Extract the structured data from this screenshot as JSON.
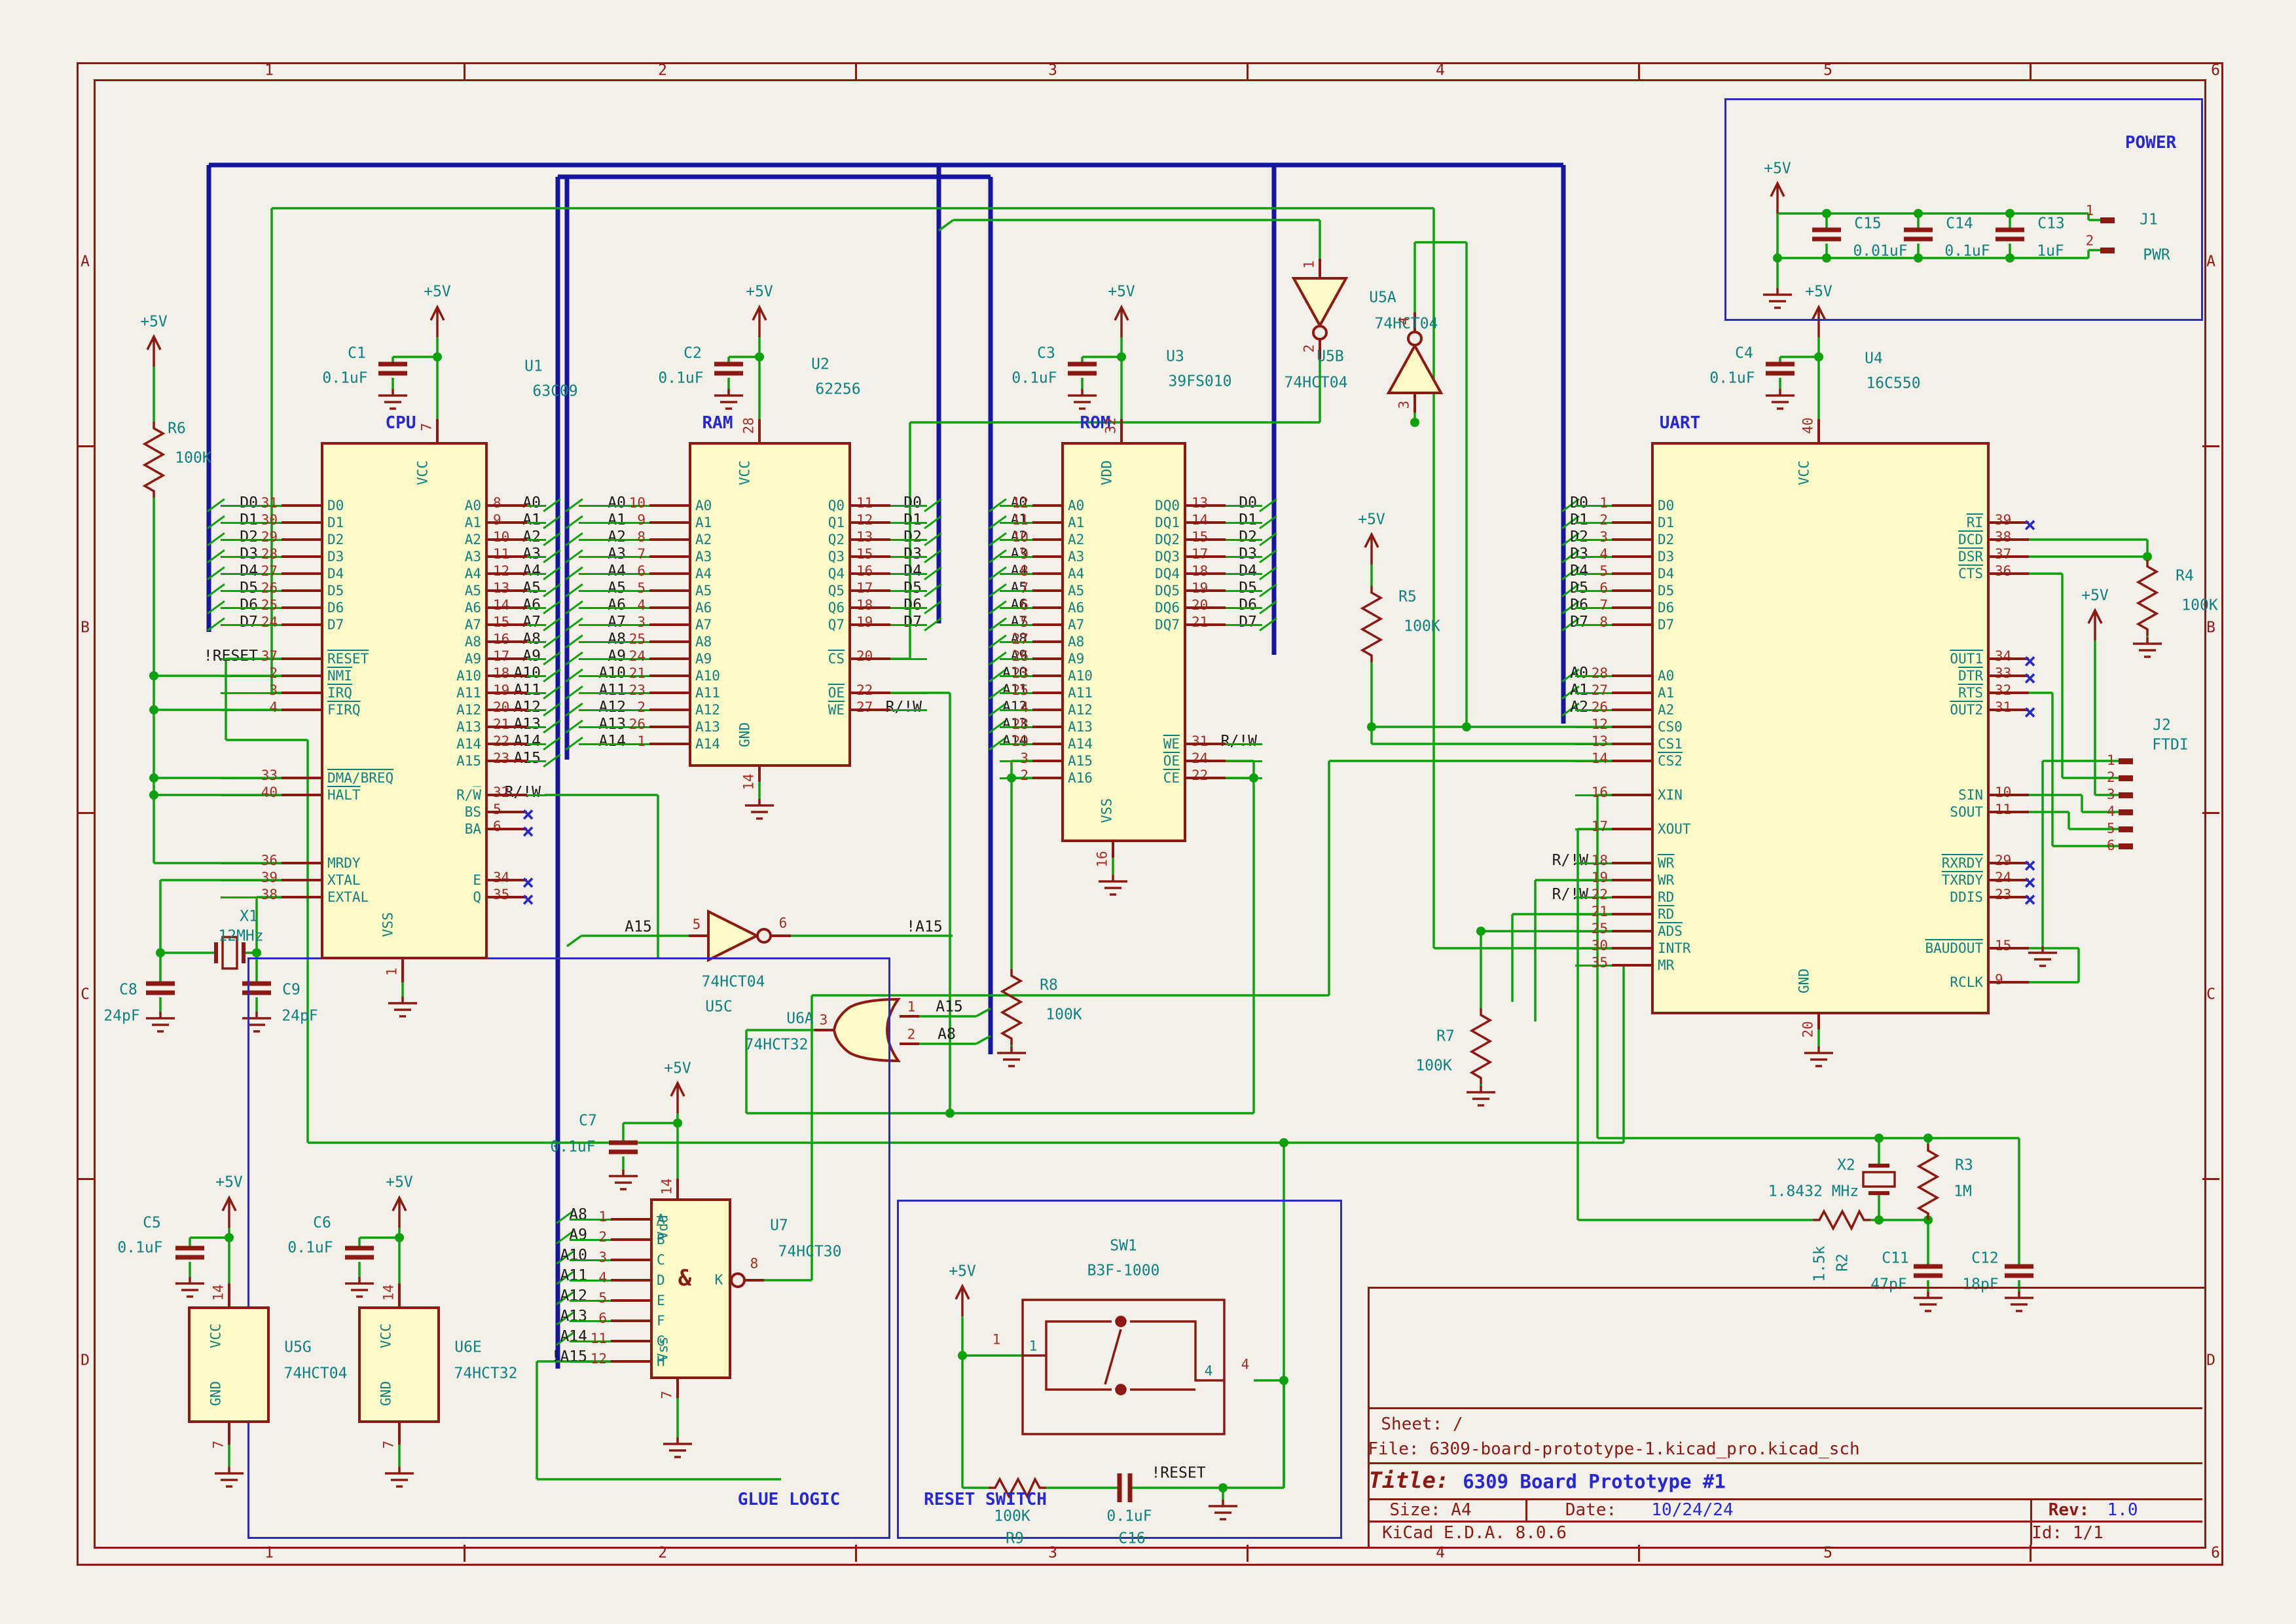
{
  "sheet": {
    "columns": [
      "1",
      "2",
      "3",
      "4",
      "5",
      "6"
    ],
    "rows": [
      "A",
      "B",
      "C",
      "D"
    ]
  },
  "title_block": {
    "sheet": "Sheet: /",
    "file": "File: 6309-board-prototype-1.kicad_pro.kicad_sch",
    "title_label": "Title:",
    "title": "6309 Board Prototype #1",
    "size": "Size: A4",
    "date_label": "Date:",
    "date": "10/24/24",
    "rev_label": "Rev:",
    "rev": "1.0",
    "tool": "KiCad E.D.A. 8.0.6",
    "id": "Id: 1/1"
  },
  "section_labels": {
    "power": "POWER",
    "glue": "GLUE LOGIC",
    "reset": "RESET SWITCH"
  },
  "power_net": "+5V",
  "net_labels": {
    "reset": "!RESET",
    "rw": "R/!W",
    "a15": "A15",
    "na15": "!A15",
    "a8": "A8"
  },
  "components": {
    "cpu": {
      "section": "CPU",
      "ref": "U1",
      "value": "63C09",
      "top": {
        "n": "7",
        "t": "VCC"
      },
      "bottom": {
        "n": "1",
        "t": "VSS"
      },
      "left": [
        {
          "n": "31",
          "t": "D0",
          "l": "D0",
          "s": 1
        },
        {
          "n": "30",
          "t": "D1",
          "l": "D1",
          "s": 1
        },
        {
          "n": "29",
          "t": "D2",
          "l": "D2",
          "s": 1
        },
        {
          "n": "28",
          "t": "D3",
          "l": "D3",
          "s": 1
        },
        {
          "n": "27",
          "t": "D4",
          "l": "D4",
          "s": 1
        },
        {
          "n": "26",
          "t": "D5",
          "l": "D5",
          "s": 1
        },
        {
          "n": "25",
          "t": "D6",
          "l": "D6",
          "s": 1
        },
        {
          "n": "24",
          "t": "D7",
          "l": "D7",
          "s": 1
        },
        {
          "sp": 1
        },
        {
          "n": "37",
          "t": "RESET",
          "b": 1,
          "l": "!RESET"
        },
        {
          "n": "2",
          "t": "NMI",
          "b": 1
        },
        {
          "n": "3",
          "t": "IRQ",
          "b": 1
        },
        {
          "n": "4",
          "t": "FIRQ",
          "b": 1
        },
        {
          "sp": 3
        },
        {
          "n": "33",
          "t": "DMA/BREQ",
          "b": 1
        },
        {
          "n": "40",
          "t": "HALT",
          "b": 1
        },
        {
          "sp": 3
        },
        {
          "n": "36",
          "t": "MRDY"
        },
        {
          "n": "39",
          "t": "XTAL"
        },
        {
          "n": "38",
          "t": "EXTAL"
        }
      ],
      "right": [
        {
          "n": "8",
          "t": "A0",
          "l": "A0",
          "s": 1
        },
        {
          "n": "9",
          "t": "A1",
          "l": "A1",
          "s": 1
        },
        {
          "n": "10",
          "t": "A2",
          "l": "A2",
          "s": 1
        },
        {
          "n": "11",
          "t": "A3",
          "l": "A3",
          "s": 1
        },
        {
          "n": "12",
          "t": "A4",
          "l": "A4",
          "s": 1
        },
        {
          "n": "13",
          "t": "A5",
          "l": "A5",
          "s": 1
        },
        {
          "n": "14",
          "t": "A6",
          "l": "A6",
          "s": 1
        },
        {
          "n": "15",
          "t": "A7",
          "l": "A7",
          "s": 1
        },
        {
          "n": "16",
          "t": "A8",
          "l": "A8",
          "s": 1
        },
        {
          "n": "17",
          "t": "A9",
          "l": "A9",
          "s": 1
        },
        {
          "n": "18",
          "t": "A10",
          "l": "A10",
          "s": 1
        },
        {
          "n": "19",
          "t": "A11",
          "l": "A11",
          "s": 1
        },
        {
          "n": "20",
          "t": "A12",
          "l": "A12",
          "s": 1
        },
        {
          "n": "21",
          "t": "A13",
          "l": "A13",
          "s": 1
        },
        {
          "n": "22",
          "t": "A14",
          "l": "A14",
          "s": 1
        },
        {
          "n": "23",
          "t": "A15",
          "l": "A15",
          "s": 1
        },
        {
          "sp": 1
        },
        {
          "n": "32",
          "t": "R/W̅",
          "l": "R/!W"
        },
        {
          "n": "5",
          "t": "BS",
          "x": 1
        },
        {
          "n": "6",
          "t": "BA",
          "x": 1
        },
        {
          "sp": 2
        },
        {
          "n": "34",
          "t": "E",
          "x": 1
        },
        {
          "n": "35",
          "t": "Q",
          "x": 1
        }
      ]
    },
    "ram": {
      "section": "RAM",
      "ref": "U2",
      "value": "62256",
      "top": {
        "n": "28",
        "t": "VCC"
      },
      "bottom": {
        "n": "14",
        "t": "GND"
      },
      "left": [
        {
          "n": "10",
          "t": "A0",
          "l": "A0",
          "s": 1
        },
        {
          "n": "9",
          "t": "A1",
          "l": "A1",
          "s": 1
        },
        {
          "n": "8",
          "t": "A2",
          "l": "A2",
          "s": 1
        },
        {
          "n": "7",
          "t": "A3",
          "l": "A3",
          "s": 1
        },
        {
          "n": "6",
          "t": "A4",
          "l": "A4",
          "s": 1
        },
        {
          "n": "5",
          "t": "A5",
          "l": "A5",
          "s": 1
        },
        {
          "n": "4",
          "t": "A6",
          "l": "A6",
          "s": 1
        },
        {
          "n": "3",
          "t": "A7",
          "l": "A7",
          "s": 1
        },
        {
          "n": "25",
          "t": "A8",
          "l": "A8",
          "s": 1
        },
        {
          "n": "24",
          "t": "A9",
          "l": "A9",
          "s": 1
        },
        {
          "n": "21",
          "t": "A10",
          "l": "A10",
          "s": 1
        },
        {
          "n": "23",
          "t": "A11",
          "l": "A11",
          "s": 1
        },
        {
          "n": "2",
          "t": "A12",
          "l": "A12",
          "s": 1
        },
        {
          "n": "26",
          "t": "A13",
          "l": "A13",
          "s": 1
        },
        {
          "n": "1",
          "t": "A14",
          "l": "A14",
          "s": 1
        }
      ],
      "right": [
        {
          "n": "11",
          "t": "Q0",
          "l": "D0",
          "s": 1
        },
        {
          "n": "12",
          "t": "Q1",
          "l": "D1",
          "s": 1
        },
        {
          "n": "13",
          "t": "Q2",
          "l": "D2",
          "s": 1
        },
        {
          "n": "15",
          "t": "Q3",
          "l": "D3",
          "s": 1
        },
        {
          "n": "16",
          "t": "Q4",
          "l": "D4",
          "s": 1
        },
        {
          "n": "17",
          "t": "Q5",
          "l": "D5",
          "s": 1
        },
        {
          "n": "18",
          "t": "Q6",
          "l": "D6",
          "s": 1
        },
        {
          "n": "19",
          "t": "Q7",
          "l": "D7",
          "s": 1
        },
        {
          "sp": 1
        },
        {
          "n": "20",
          "t": "CS",
          "b": 1
        },
        {
          "sp": 1
        },
        {
          "n": "22",
          "t": "OE",
          "b": 1
        },
        {
          "n": "27",
          "t": "WE",
          "b": 1,
          "l": "R/!W"
        }
      ]
    },
    "rom": {
      "section": "ROM",
      "ref": "U3",
      "value": "39FS010",
      "top": {
        "n": "32",
        "t": "VDD"
      },
      "bottom": {
        "n": "16",
        "t": "VSS"
      },
      "left": [
        {
          "n": "12",
          "t": "A0",
          "l": "A0",
          "s": 1
        },
        {
          "n": "11",
          "t": "A1",
          "l": "A1",
          "s": 1
        },
        {
          "n": "10",
          "t": "A2",
          "l": "A2",
          "s": 1
        },
        {
          "n": "9",
          "t": "A3",
          "l": "A3",
          "s": 1
        },
        {
          "n": "8",
          "t": "A4",
          "l": "A4",
          "s": 1
        },
        {
          "n": "7",
          "t": "A5",
          "l": "A5",
          "s": 1
        },
        {
          "n": "6",
          "t": "A6",
          "l": "A6",
          "s": 1
        },
        {
          "n": "5",
          "t": "A7",
          "l": "A7",
          "s": 1
        },
        {
          "n": "27",
          "t": "A8",
          "l": "A8",
          "s": 1
        },
        {
          "n": "26",
          "t": "A9",
          "l": "A9",
          "s": 1
        },
        {
          "n": "23",
          "t": "A10",
          "l": "A10",
          "s": 1
        },
        {
          "n": "25",
          "t": "A11",
          "l": "A11",
          "s": 1
        },
        {
          "n": "4",
          "t": "A12",
          "l": "A12",
          "s": 1
        },
        {
          "n": "28",
          "t": "A13",
          "l": "A13",
          "s": 1
        },
        {
          "n": "29",
          "t": "A14",
          "l": "A14",
          "s": 1
        },
        {
          "n": "3",
          "t": "A15"
        },
        {
          "n": "2",
          "t": "A16"
        }
      ],
      "right": [
        {
          "n": "13",
          "t": "DQ0",
          "l": "D0",
          "s": 1
        },
        {
          "n": "14",
          "t": "DQ1",
          "l": "D1",
          "s": 1
        },
        {
          "n": "15",
          "t": "DQ2",
          "l": "D2",
          "s": 1
        },
        {
          "n": "17",
          "t": "DQ3",
          "l": "D3",
          "s": 1
        },
        {
          "n": "18",
          "t": "DQ4",
          "l": "D4",
          "s": 1
        },
        {
          "n": "19",
          "t": "DQ5",
          "l": "D5",
          "s": 1
        },
        {
          "n": "20",
          "t": "DQ6",
          "l": "D6",
          "s": 1
        },
        {
          "n": "21",
          "t": "DQ7",
          "l": "D7",
          "s": 1
        },
        {
          "sp": 6
        },
        {
          "n": "31",
          "t": "WE",
          "b": 1,
          "l": "R/!W"
        },
        {
          "n": "24",
          "t": "OE",
          "b": 1
        },
        {
          "n": "22",
          "t": "CE",
          "b": 1
        }
      ]
    },
    "uart": {
      "section": "UART",
      "ref": "U4",
      "value": "16C550",
      "top": {
        "n": "40",
        "t": "VCC"
      },
      "bottom": {
        "n": "20",
        "t": "GND"
      },
      "left": [
        {
          "n": "1",
          "t": "D0",
          "l": "D0",
          "s": 1
        },
        {
          "n": "2",
          "t": "D1",
          "l": "D1",
          "s": 1
        },
        {
          "n": "3",
          "t": "D2",
          "l": "D2",
          "s": 1
        },
        {
          "n": "4",
          "t": "D3",
          "l": "D3",
          "s": 1
        },
        {
          "n": "5",
          "t": "D4",
          "l": "D4",
          "s": 1
        },
        {
          "n": "6",
          "t": "D5",
          "l": "D5",
          "s": 1
        },
        {
          "n": "7",
          "t": "D6",
          "l": "D6",
          "s": 1
        },
        {
          "n": "8",
          "t": "D7",
          "l": "D7",
          "s": 1
        },
        {
          "sp": 2
        },
        {
          "n": "28",
          "t": "A0",
          "l": "A0",
          "s": 1
        },
        {
          "n": "27",
          "t": "A1",
          "l": "A1",
          "s": 1
        },
        {
          "n": "26",
          "t": "A2",
          "l": "A2",
          "s": 1
        },
        {
          "n": "12",
          "t": "CS0"
        },
        {
          "n": "13",
          "t": "CS1"
        },
        {
          "n": "14",
          "t": "CS2",
          "b": 1
        },
        {
          "sp": 1
        },
        {
          "n": "16",
          "t": "XIN"
        },
        {
          "sp": 1
        },
        {
          "n": "17",
          "t": "XOUT"
        },
        {
          "sp": 1
        },
        {
          "n": "18",
          "t": "WR",
          "b": 1,
          "l": "R/!W"
        },
        {
          "n": "19",
          "t": "WR"
        },
        {
          "n": "22",
          "t": "RD",
          "l": "R/!W"
        },
        {
          "n": "21",
          "t": "RD",
          "b": 1
        },
        {
          "n": "25",
          "t": "ADS",
          "b": 1
        },
        {
          "n": "30",
          "t": "INTR"
        },
        {
          "n": "35",
          "t": "MR"
        }
      ],
      "right": [
        {
          "sp": 1
        },
        {
          "n": "39",
          "t": "RI",
          "b": 1,
          "x": 1
        },
        {
          "n": "38",
          "t": "DCD",
          "b": 1
        },
        {
          "n": "37",
          "t": "DSR",
          "b": 1
        },
        {
          "n": "36",
          "t": "CTS",
          "b": 1
        },
        {
          "sp": 4
        },
        {
          "n": "34",
          "t": "OUT1",
          "b": 1,
          "x": 1
        },
        {
          "n": "33",
          "t": "DTR",
          "b": 1,
          "x": 1
        },
        {
          "n": "32",
          "t": "RTS",
          "b": 1
        },
        {
          "n": "31",
          "t": "OUT2",
          "b": 1,
          "x": 1
        },
        {
          "sp": 4
        },
        {
          "n": "10",
          "t": "SIN"
        },
        {
          "n": "11",
          "t": "SOUT"
        },
        {
          "sp": 2
        },
        {
          "n": "29",
          "t": "RXRDY",
          "b": 1,
          "x": 1
        },
        {
          "n": "24",
          "t": "TXRDY",
          "b": 1,
          "x": 1
        },
        {
          "n": "23",
          "t": "DDIS",
          "x": 1
        },
        {
          "sp": 2
        },
        {
          "n": "15",
          "t": "BAUDOUT",
          "b": 1
        },
        {
          "sp": 1
        },
        {
          "n": "9",
          "t": "RCLK"
        }
      ]
    },
    "u5a": {
      "ref": "U5A",
      "value": "74HCT04",
      "pin_in": "1",
      "pin_out": "2"
    },
    "u5b": {
      "ref": "U5B",
      "value": "74HCT04",
      "pin_in": "3",
      "pin_out": "4"
    },
    "u5c": {
      "ref": "U5C",
      "value": "74HCT04",
      "pin_in": "5",
      "pin_out": "6"
    },
    "u6a": {
      "ref": "U6A",
      "value": "74HCT32",
      "pin_out": "3",
      "pin_in1": "1",
      "pin_in2": "2"
    },
    "u7": {
      "ref": "U7",
      "value": "74HCT30",
      "gate": "&",
      "out_n": "8",
      "out_t": "K",
      "top": {
        "n": "14",
        "t": "Vdd"
      },
      "bottom": {
        "n": "7",
        "t": "Vss"
      },
      "left": [
        {
          "n": "1",
          "t": "A",
          "l": "A8",
          "s": 1
        },
        {
          "n": "2",
          "t": "B",
          "l": "A9",
          "s": 1
        },
        {
          "n": "3",
          "t": "C",
          "l": "A10",
          "s": 1
        },
        {
          "n": "4",
          "t": "D",
          "l": "A11",
          "s": 1
        },
        {
          "n": "5",
          "t": "E",
          "l": "A12",
          "s": 1
        },
        {
          "n": "6",
          "t": "F",
          "l": "A13",
          "s": 1
        },
        {
          "n": "11",
          "t": "G",
          "l": "A14",
          "s": 1
        },
        {
          "n": "12",
          "t": "H",
          "l": "!A15"
        }
      ]
    },
    "u5g": {
      "ref": "U5G",
      "value": "74HCT04",
      "top": {
        "n": "14",
        "t": "VCC"
      },
      "bottom": {
        "n": "7",
        "t": "GND"
      }
    },
    "u6e": {
      "ref": "U6E",
      "value": "74HCT32",
      "top": {
        "n": "14",
        "t": "VCC"
      },
      "bottom": {
        "n": "7",
        "t": "GND"
      }
    },
    "sw1": {
      "ref": "SW1",
      "value": "B3F-1000",
      "pin1": "1",
      "pin4": "4"
    },
    "j1": {
      "ref": "J1",
      "value": "PWR",
      "pin1": "1",
      "pin2": "2"
    },
    "j2": {
      "ref": "J2",
      "value": "FTDI",
      "pins": [
        {
          "n": "1",
          "t": "GND"
        },
        {
          "n": "2",
          "t": "CTS"
        },
        {
          "n": "3",
          "t": "5V"
        },
        {
          "n": "4",
          "t": "TX"
        },
        {
          "n": "5",
          "t": "RX"
        },
        {
          "n": "6",
          "t": "RTS"
        }
      ]
    },
    "c1": {
      "ref": "C1",
      "value": "0.1uF"
    },
    "c2": {
      "ref": "C2",
      "value": "0.1uF"
    },
    "c3": {
      "ref": "C3",
      "value": "0.1uF"
    },
    "c4": {
      "ref": "C4",
      "value": "0.1uF"
    },
    "c5": {
      "ref": "C5",
      "value": "0.1uF"
    },
    "c6": {
      "ref": "C6",
      "value": "0.1uF"
    },
    "c7": {
      "ref": "C7",
      "value": "0.1uF"
    },
    "c8": {
      "ref": "C8",
      "value": "24pF"
    },
    "c9": {
      "ref": "C9",
      "value": "24pF"
    },
    "c11": {
      "ref": "C11",
      "value": "47pF"
    },
    "c12": {
      "ref": "C12",
      "value": "18pF"
    },
    "c13": {
      "ref": "C13",
      "value": "1uF"
    },
    "c14": {
      "ref": "C14",
      "value": "0.1uF"
    },
    "c15": {
      "ref": "C15",
      "value": "0.01uF"
    },
    "c16": {
      "ref": "C16",
      "value": "0.1uF"
    },
    "r2": {
      "ref": "R2",
      "value": "1.5k"
    },
    "r3": {
      "ref": "R3",
      "value": "1M"
    },
    "r4": {
      "ref": "R4",
      "value": "100K"
    },
    "r5": {
      "ref": "R5",
      "value": "100K"
    },
    "r6": {
      "ref": "R6",
      "value": "100K"
    },
    "r7": {
      "ref": "R7",
      "value": "100K"
    },
    "r8": {
      "ref": "R8",
      "value": "100K"
    },
    "r9": {
      "ref": "R9",
      "value": "100K"
    },
    "x1": {
      "ref": "X1",
      "value": "12MHz"
    },
    "x2": {
      "ref": "X2",
      "value": "1.8432 MHz"
    }
  }
}
